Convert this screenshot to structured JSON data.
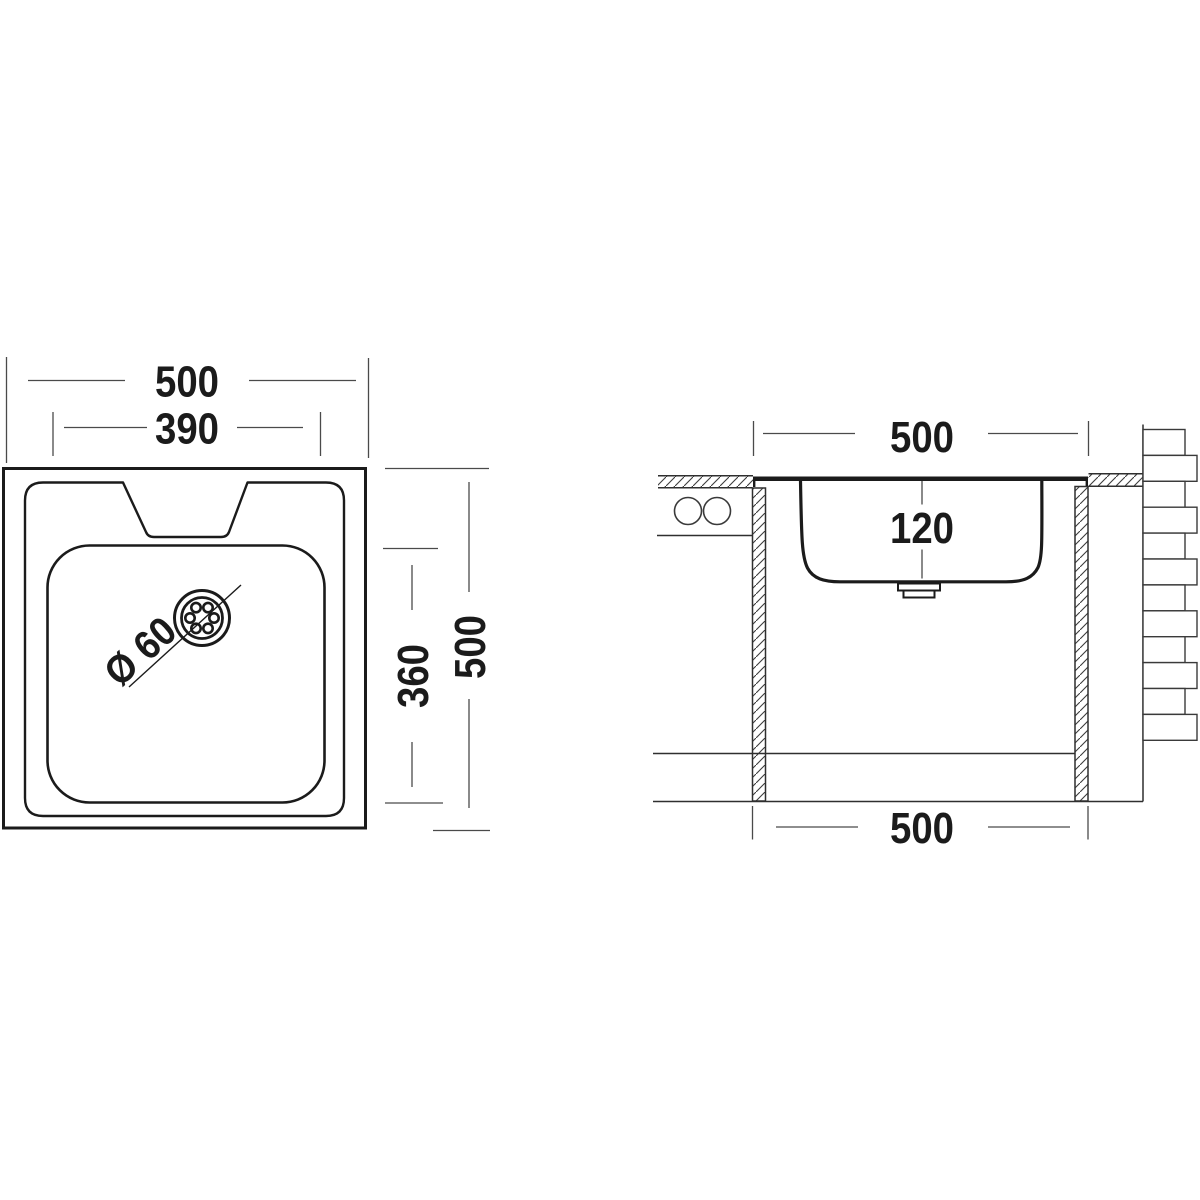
{
  "colors": {
    "line": "#1b1b1b",
    "dimension": "#4a4a4a",
    "background": "#ffffff"
  },
  "top_view": {
    "overall_width": "500",
    "bowl_width": "390",
    "overall_depth": "500",
    "bowl_depth": "360",
    "drain_diameter": "Ø 60"
  },
  "section_view": {
    "rim_width": "500",
    "bowl_depth": "120",
    "base_width": "500"
  }
}
